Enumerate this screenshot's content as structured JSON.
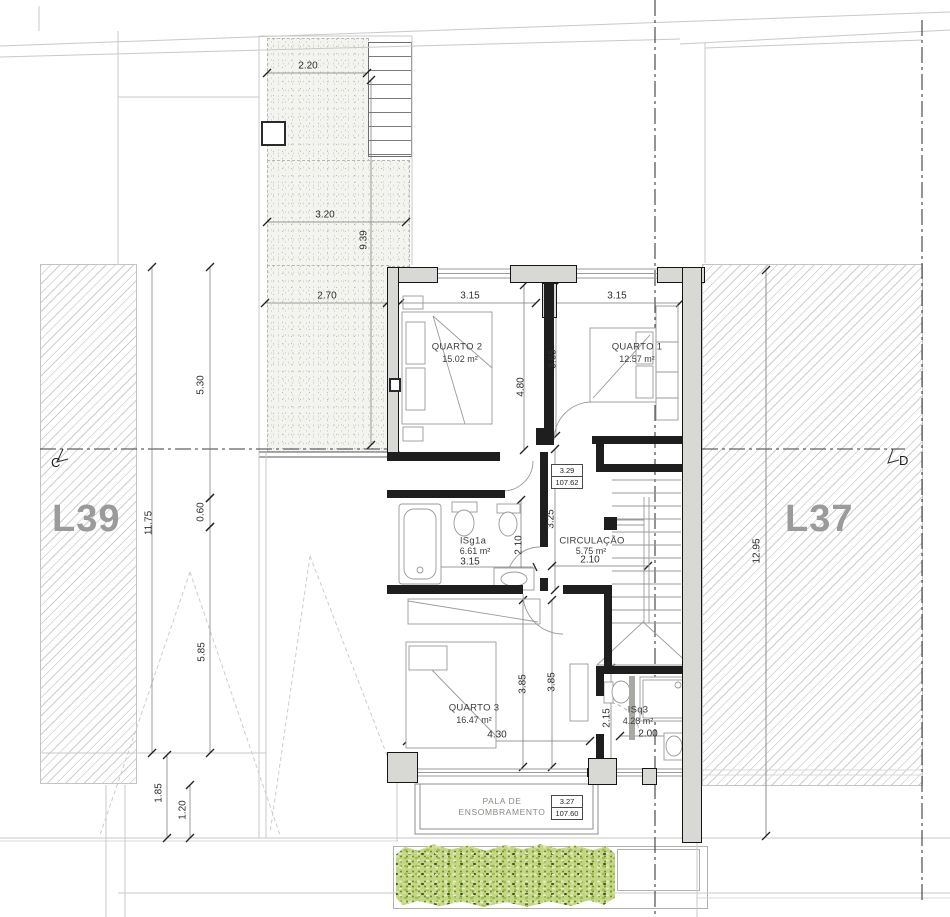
{
  "lots": {
    "l39": "L39",
    "l37": "L37"
  },
  "sections": {
    "c": "C",
    "d": "D"
  },
  "rooms": {
    "quarto2": {
      "name": "QUARTO 2",
      "area": "15.02 m²"
    },
    "quarto1": {
      "name": "QUARTO 1",
      "area": "12.57 m²"
    },
    "isg1a": {
      "name": "ISg1a",
      "area": "6.61 m²"
    },
    "circulacao": {
      "name": "CIRCULAÇÃO",
      "area": "5.75 m²"
    },
    "quarto3": {
      "name": "QUARTO 3",
      "area": "16.47 m²"
    },
    "isq3": {
      "name": "ISq3",
      "area": "4.28 m²"
    }
  },
  "levels": {
    "upper": {
      "relative": "3.29",
      "absolute": "107.62"
    },
    "lower": {
      "relative": "3.27",
      "absolute": "107.60"
    }
  },
  "pala": {
    "line1": "PALA DE",
    "line2": "ENSOMBRAMENTO"
  },
  "dimensions": {
    "d220": "2.20",
    "d320": "3.20",
    "d939": "9.39",
    "d270": "2.70",
    "d530": "5.30",
    "d1175": "11.75",
    "d060": "0.60",
    "d585": "5.85",
    "d185": "1.85",
    "d120": "1.20",
    "d315a": "3.15",
    "d315b": "3.15",
    "d480": "4.80",
    "d365": "3.65",
    "d315c": "3.15",
    "d210a": "2.10",
    "d325": "3.25",
    "d210b": "2.10",
    "d385a": "3.85",
    "d385b": "3.85",
    "d430": "4.30",
    "d215": "2.15",
    "d200": "2.00",
    "d1295": "12.95"
  }
}
